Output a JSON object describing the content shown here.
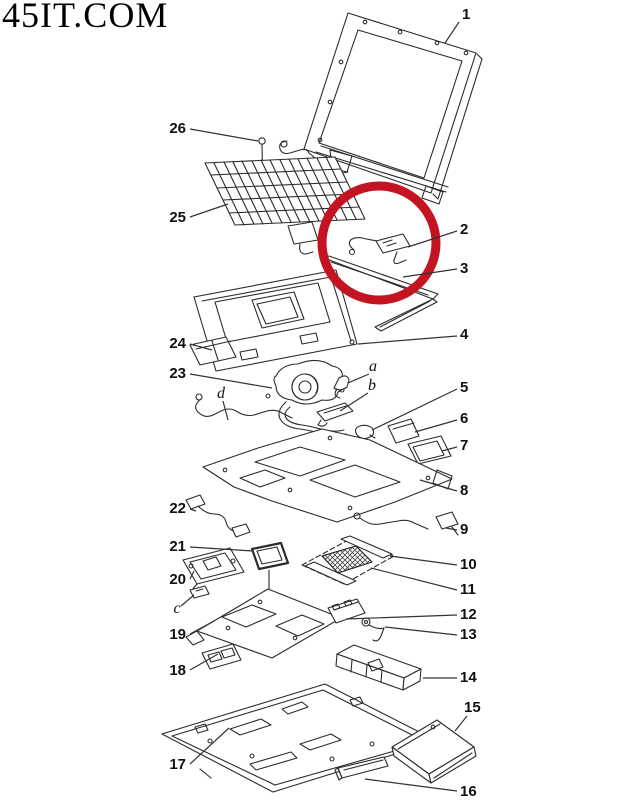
{
  "watermark": {
    "text": "45IT.COM"
  },
  "highlight_circle": {
    "cx": 379,
    "cy": 243,
    "r": 57,
    "color": "#c41422",
    "stroke_width": 9
  },
  "callouts": [
    {
      "label": "1",
      "tx": 462,
      "ty": 19,
      "anchor": "start",
      "style": "number",
      "line": [
        459,
        22,
        445,
        43
      ]
    },
    {
      "label": "2",
      "tx": 460,
      "ty": 234,
      "anchor": "start",
      "style": "number",
      "line": [
        457,
        231,
        408,
        247
      ]
    },
    {
      "label": "3",
      "tx": 460,
      "ty": 273,
      "anchor": "start",
      "style": "number",
      "line": [
        457,
        269,
        403,
        277
      ]
    },
    {
      "label": "4",
      "tx": 460,
      "ty": 339,
      "anchor": "start",
      "style": "number",
      "line": [
        457,
        336,
        358,
        344
      ]
    },
    {
      "label": "5",
      "tx": 460,
      "ty": 392,
      "anchor": "start",
      "style": "number",
      "line": [
        457,
        389,
        372,
        430
      ]
    },
    {
      "label": "6",
      "tx": 460,
      "ty": 423,
      "anchor": "start",
      "style": "number",
      "line": [
        457,
        420,
        415,
        432
      ]
    },
    {
      "label": "7",
      "tx": 460,
      "ty": 450,
      "anchor": "start",
      "style": "number",
      "line": [
        457,
        447,
        442,
        451
      ]
    },
    {
      "label": "8",
      "tx": 460,
      "ty": 495,
      "anchor": "start",
      "style": "number",
      "line": [
        457,
        491,
        420,
        480
      ]
    },
    {
      "label": "9",
      "tx": 460,
      "ty": 534,
      "anchor": "start",
      "style": "number",
      "line": [
        457,
        530,
        446,
        528
      ]
    },
    {
      "label": "10",
      "tx": 460,
      "ty": 569,
      "anchor": "start",
      "style": "number",
      "line": [
        457,
        565,
        390,
        556
      ]
    },
    {
      "label": "11",
      "tx": 460,
      "ty": 594,
      "anchor": "start",
      "style": "number",
      "line": [
        457,
        590,
        371,
        568
      ]
    },
    {
      "label": "12",
      "tx": 460,
      "ty": 619,
      "anchor": "start",
      "style": "number",
      "line": [
        457,
        615,
        346,
        619
      ]
    },
    {
      "label": "13",
      "tx": 460,
      "ty": 639,
      "anchor": "start",
      "style": "number",
      "line": [
        457,
        635,
        385,
        627
      ]
    },
    {
      "label": "14",
      "tx": 460,
      "ty": 682,
      "anchor": "start",
      "style": "number",
      "line": [
        457,
        678,
        423,
        678
      ]
    },
    {
      "label": "15",
      "tx": 464,
      "ty": 712,
      "anchor": "start",
      "style": "number",
      "line": [
        467,
        716,
        455,
        731
      ]
    },
    {
      "label": "16",
      "tx": 460,
      "ty": 796,
      "anchor": "start",
      "style": "number",
      "line": [
        457,
        791,
        365,
        779
      ]
    },
    {
      "label": "17",
      "tx": 186,
      "ty": 769,
      "anchor": "end",
      "style": "number",
      "line": [
        190,
        764,
        229,
        728
      ]
    },
    {
      "label": "18",
      "tx": 186,
      "ty": 675,
      "anchor": "end",
      "style": "number",
      "line": [
        190,
        670,
        218,
        654
      ]
    },
    {
      "label": "19",
      "tx": 186,
      "ty": 639,
      "anchor": "end",
      "style": "number",
      "line": [
        190,
        634,
        214,
        621
      ]
    },
    {
      "label": "20",
      "tx": 186,
      "ty": 584,
      "anchor": "end",
      "style": "number",
      "line": [
        190,
        579,
        194,
        571
      ]
    },
    {
      "label": "21",
      "tx": 186,
      "ty": 551,
      "anchor": "end",
      "style": "number",
      "line": [
        190,
        547,
        253,
        551
      ]
    },
    {
      "label": "22",
      "tx": 186,
      "ty": 513,
      "anchor": "end",
      "style": "number",
      "line": [
        190,
        509,
        196,
        511
      ]
    },
    {
      "label": "23",
      "tx": 186,
      "ty": 378,
      "anchor": "end",
      "style": "number",
      "line": [
        190,
        374,
        272,
        388
      ]
    },
    {
      "label": "24",
      "tx": 186,
      "ty": 348,
      "anchor": "end",
      "style": "number",
      "line": [
        190,
        344,
        212,
        350
      ]
    },
    {
      "label": "25",
      "tx": 186,
      "ty": 222,
      "anchor": "end",
      "style": "number",
      "line": [
        190,
        217,
        228,
        204
      ]
    },
    {
      "label": "26",
      "tx": 186,
      "ty": 133,
      "anchor": "end",
      "style": "number",
      "line": [
        190,
        129,
        258,
        141
      ]
    },
    {
      "label": "a",
      "tx": 373,
      "ty": 371,
      "anchor": "middle",
      "style": "letter",
      "line": [
        369,
        374,
        348,
        383
      ]
    },
    {
      "label": "b",
      "tx": 372,
      "ty": 390,
      "anchor": "middle",
      "style": "letter",
      "line": [
        368,
        393,
        340,
        411
      ]
    },
    {
      "label": "c",
      "tx": 177,
      "ty": 613,
      "anchor": "middle",
      "style": "letter",
      "line": [
        181,
        606,
        194,
        595
      ]
    },
    {
      "label": "d",
      "tx": 221,
      "ty": 398,
      "anchor": "middle",
      "style": "letter",
      "line": [
        223,
        401,
        228,
        420
      ]
    }
  ]
}
